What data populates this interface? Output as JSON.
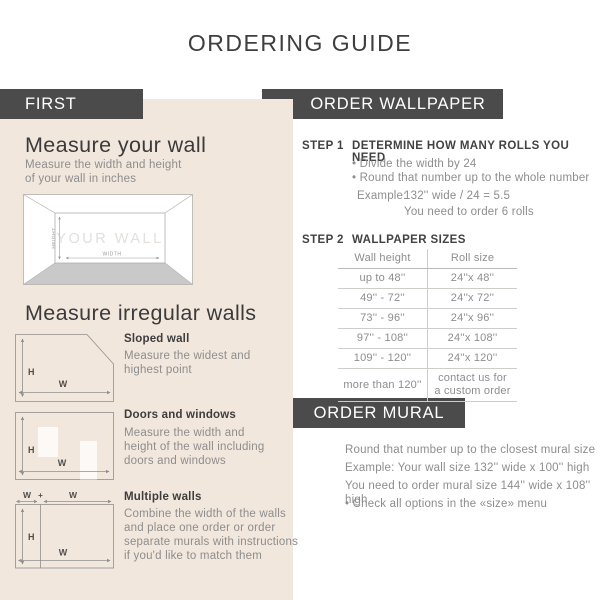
{
  "title": "ORDERING GUIDE",
  "colors": {
    "dark": "#4b4b4b",
    "beige": "#f2e7dd"
  },
  "left": {
    "badge": "FIRST",
    "measure_wall": {
      "heading": "Measure your wall",
      "subtext": "Measure the width and height\nof your wall in inches"
    },
    "wall_diagram": {
      "label": "YOUR WALL",
      "height": "HEIGHT",
      "width": "WIDTH"
    },
    "irregular": {
      "heading": "Measure irregular walls",
      "items": [
        {
          "title": "Sloped wall",
          "body": "Measure the widest and\nhighest point"
        },
        {
          "title": "Doors and windows",
          "body": "Measure the width and\nheight of the wall including\ndoors and windows"
        },
        {
          "title": "Multiple walls",
          "body": "Combine the width of the walls\nand place one order or order\nseparate murals with instructions\nif you'd like to match them"
        }
      ]
    },
    "diagram_labels": {
      "h": "H",
      "w": "W",
      "plus": "+"
    }
  },
  "wallpaper": {
    "badge": "ORDER WALLPAPER",
    "step1": {
      "label": "STEP 1",
      "title": "DETERMINE HOW MANY ROLLS YOU NEED",
      "bullets": [
        "• Divide the width by 24",
        "• Round that number up to the whole number"
      ],
      "example_label": "Example:",
      "example_calc": "132'' wide / 24 = 5.5",
      "example_result": "You need to order 6 rolls"
    },
    "step2": {
      "label": "STEP 2",
      "title": "WALLPAPER SIZES",
      "table": {
        "headers": [
          "Wall height",
          "Roll size"
        ],
        "rows": [
          [
            "up to 48''",
            "24''x 48''"
          ],
          [
            "49'' - 72''",
            "24''x 72''"
          ],
          [
            "73'' - 96''",
            "24''x 96''"
          ],
          [
            "97'' - 108''",
            "24''x 108''"
          ],
          [
            "109'' - 120''",
            "24''x 120''"
          ],
          [
            "more than 120''",
            "contact us for\na custom order"
          ]
        ]
      }
    }
  },
  "mural": {
    "badge": "ORDER MURAL",
    "lines": [
      "Round that number up to the closest mural size",
      "Example: Your wall size 132'' wide x 100'' high",
      "You need to order mural size 144'' wide x 108'' high",
      "• Check all options in the «size» menu"
    ]
  }
}
